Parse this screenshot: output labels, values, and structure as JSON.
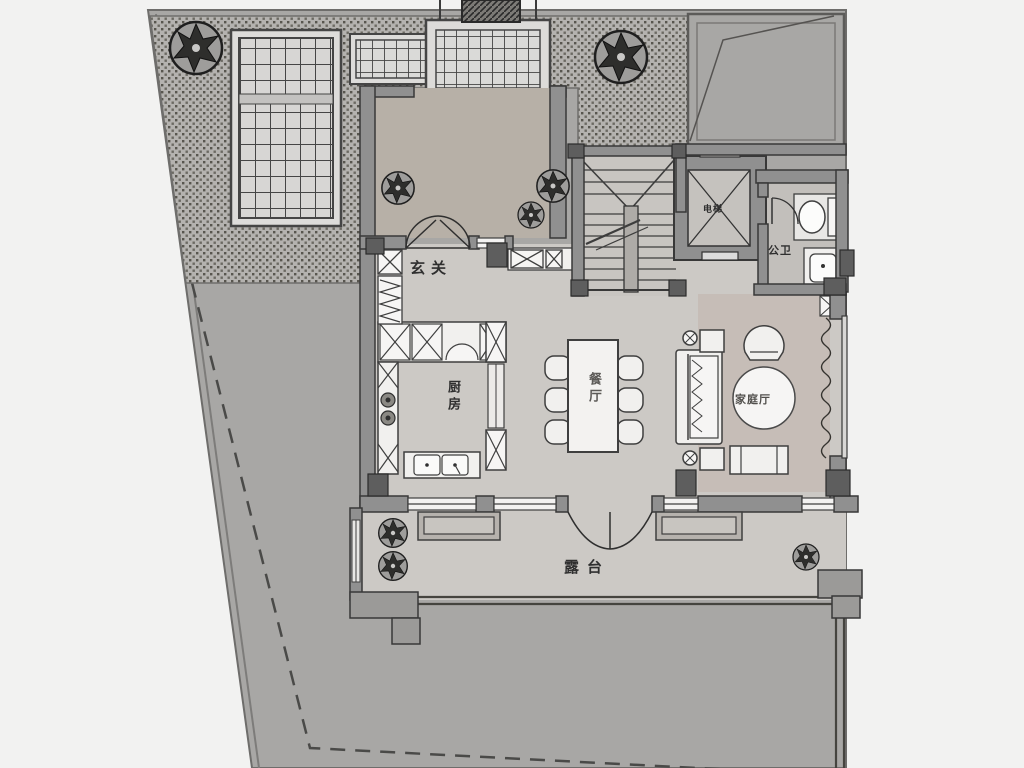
{
  "plan": {
    "title": "residential-floor-plan",
    "rooms": {
      "entry": {
        "label": "玄关"
      },
      "kitchen": {
        "label": "厨房"
      },
      "dining": {
        "label": "餐厅"
      },
      "family_room": {
        "label": "家庭厅"
      },
      "elevator": {
        "label": "电梯"
      },
      "bathroom": {
        "label": "公卫"
      },
      "terrace": {
        "label": "露台"
      }
    },
    "colors": {
      "page_bg": "#f2f2f1",
      "site": "#a8a7a5",
      "paving": "#b4b2af",
      "floor": "#ccc9c5",
      "family_floor": "#c6bdb7",
      "porch_floor": "#b7b0a7",
      "wall": "#909090",
      "wall_line": "#383838",
      "pillar": "#5e5e5e",
      "furniture": "#f1f0ee",
      "label_text": "#2f2f2f"
    }
  }
}
